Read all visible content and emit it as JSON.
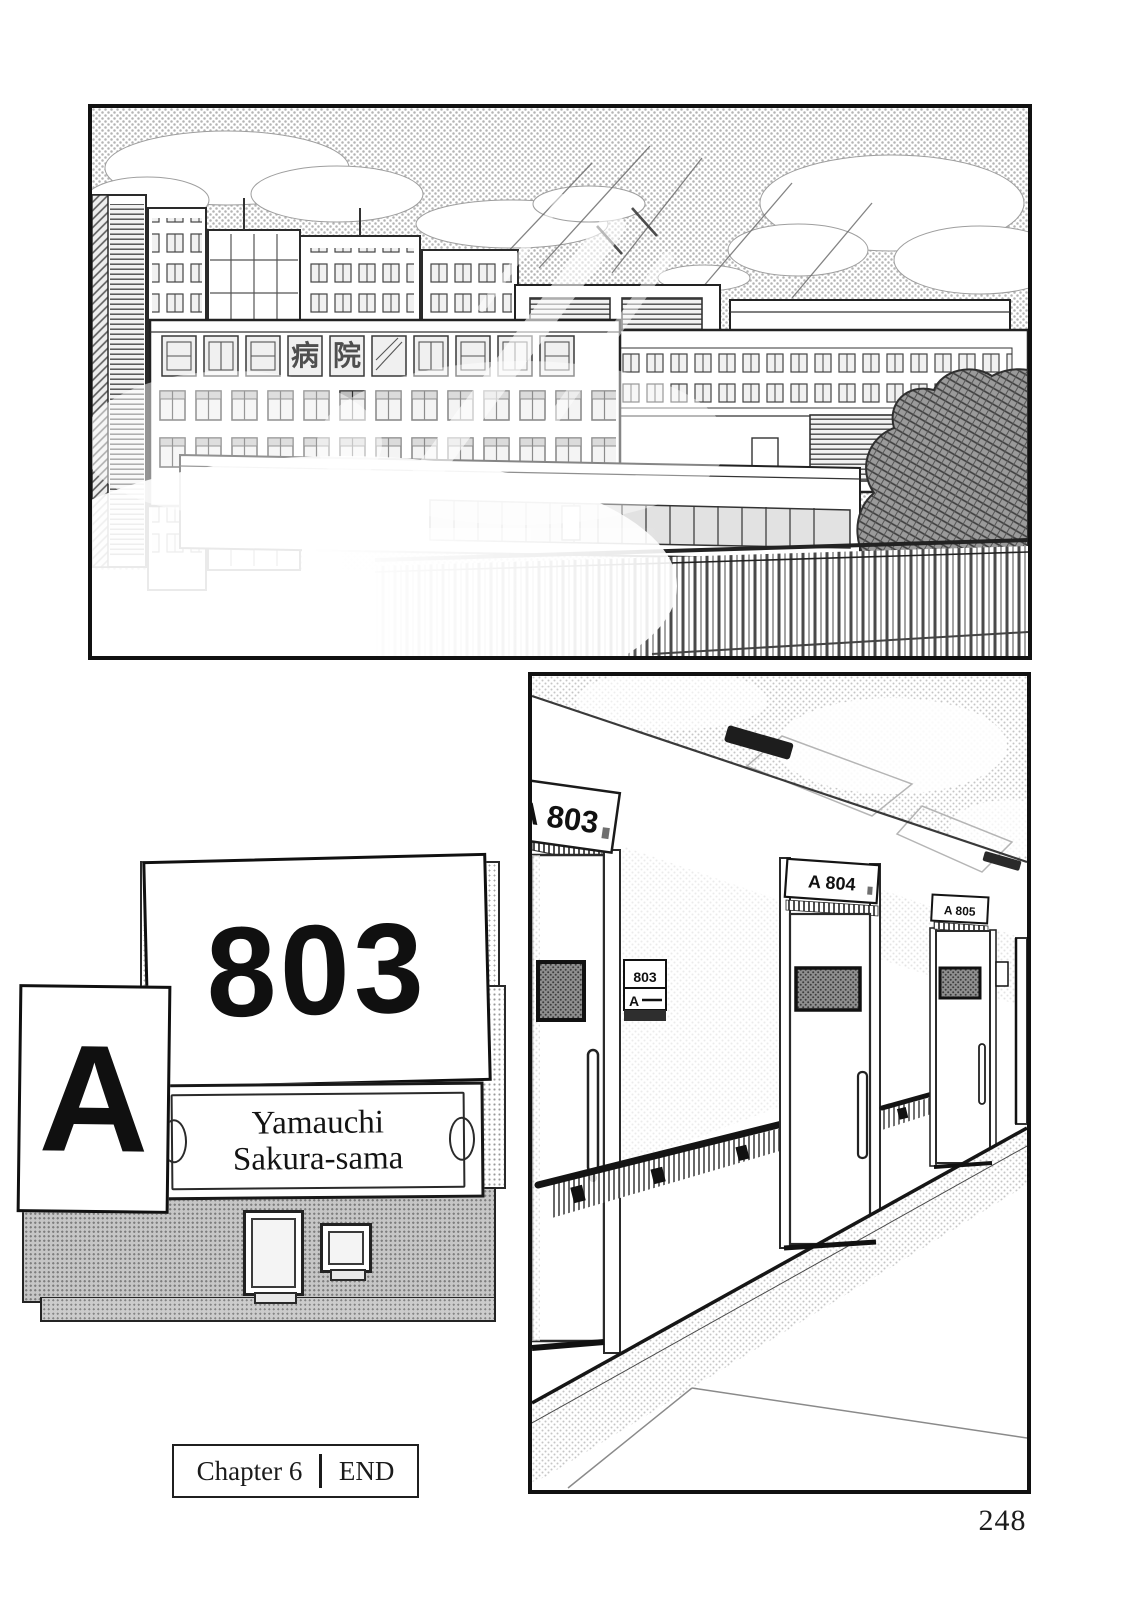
{
  "page": {
    "number_label": "248"
  },
  "panels": {
    "cityscape": {
      "hospital_sign_chars": [
        "病",
        "院"
      ]
    },
    "hallway": {
      "door_signs": [
        "A 803",
        "A 804",
        "A 805"
      ],
      "side_sign": {
        "number": "803",
        "letter": "A"
      }
    },
    "nameplate": {
      "ward_letter": "A",
      "room_number": "803",
      "name_line1": "Yamauchi",
      "name_line2": "Sakura-sama"
    }
  },
  "footer": {
    "chapter_label": "Chapter 6",
    "end_label": "END"
  },
  "colors": {
    "paper": "#ffffff",
    "ink": "#161616",
    "tone_sky": "#b4b4b4",
    "tone_gray_panel": "#c6c6c6"
  }
}
